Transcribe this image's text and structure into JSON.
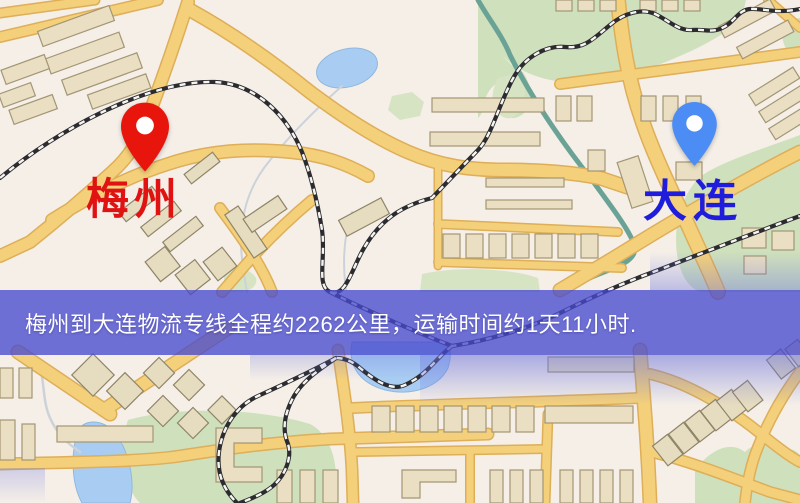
{
  "map": {
    "origin_marker": {
      "label": "梅州",
      "pin_color": "#e8150d",
      "label_color": "#e01212"
    },
    "destination_marker": {
      "label": "大连",
      "pin_color": "#4b8cf5",
      "label_color": "#1f1cdc"
    },
    "banner": {
      "text": "梅州到大连物流专线全程约2262公里，运输时间约1天11小时.",
      "background_color": "rgba(72,74,206,0.78)",
      "text_color": "#ffffff"
    },
    "colors": {
      "background": "#f5efe8",
      "road": "#f4d07a",
      "road_casing": "#deae58",
      "park": "#cfe0bd",
      "water": "#a9cdf2",
      "building": "#eadfc2",
      "railway": "#2b2b30"
    }
  }
}
